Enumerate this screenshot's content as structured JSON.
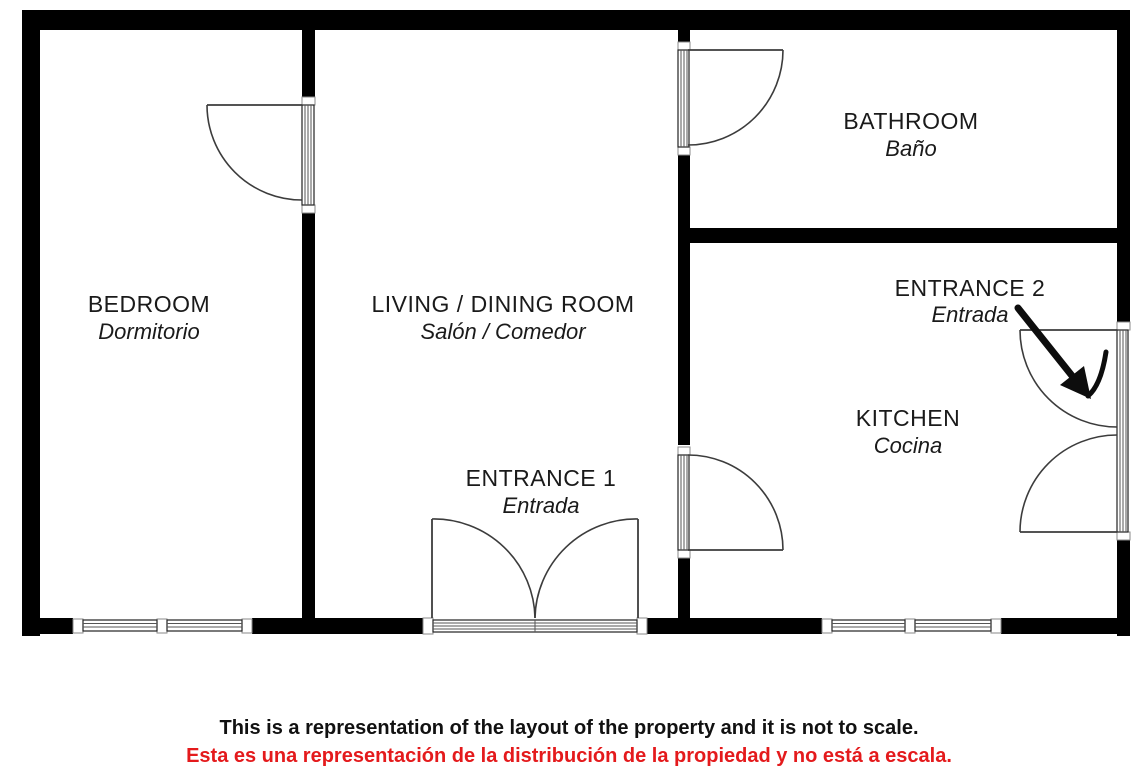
{
  "plan": {
    "labels": {
      "bedroom": {
        "en": "BEDROOM",
        "es": "Dormitorio"
      },
      "living": {
        "en": "LIVING / DINING ROOM",
        "es": "Salón / Comedor"
      },
      "bathroom": {
        "en": "BATHROOM",
        "es": "Baño"
      },
      "kitchen": {
        "en": "KITCHEN",
        "es": "Cocina"
      },
      "entrance1": {
        "en": "ENTRANCE 1",
        "es": "Entrada"
      },
      "entrance2": {
        "en": "ENTRANCE 2",
        "es": "Entrada"
      }
    },
    "colors": {
      "wall": "#000000",
      "line": "#3c3c3c",
      "text": "#1a1a1a",
      "disclaimer_en": "#111111",
      "disclaimer_es": "#e41a1c",
      "background": "#ffffff"
    }
  },
  "disclaimer": {
    "en": "This is a representation of the layout of the property and it is not to scale.",
    "es": "Esta es una representación de la distribución de la propiedad y no está a escala."
  }
}
